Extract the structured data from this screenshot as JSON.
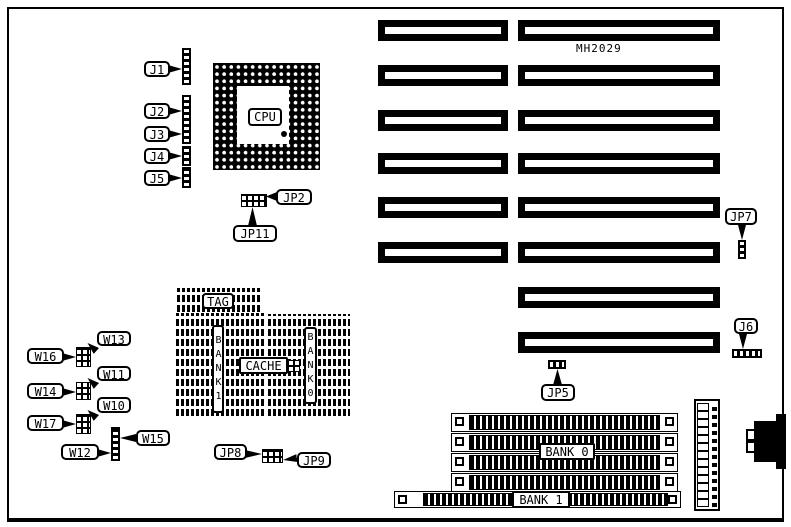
{
  "colors": {
    "ink": "#000000",
    "paper": "#ffffff"
  },
  "board": {
    "model": "MH2029"
  },
  "chips": {
    "cpu": "CPU",
    "tag": "TAG",
    "cache": "CACHE",
    "cache_bank1": "BANK1",
    "cache_bank0": "BANK0"
  },
  "memory": {
    "bank0": "BANK 0",
    "bank1": "BANK 1"
  },
  "jumpers": {
    "j1": "J1",
    "j2": "J2",
    "j3": "J3",
    "j4": "J4",
    "j5": "J5",
    "j6": "J6",
    "jp2": "JP2",
    "jp5": "JP5",
    "jp7": "JP7",
    "jp8": "JP8",
    "jp9": "JP9",
    "jp11": "JP11",
    "w10": "W10",
    "w11": "W11",
    "w12": "W12",
    "w13": "W13",
    "w14": "W14",
    "w15": "W15",
    "w16": "W16",
    "w17": "W17"
  }
}
